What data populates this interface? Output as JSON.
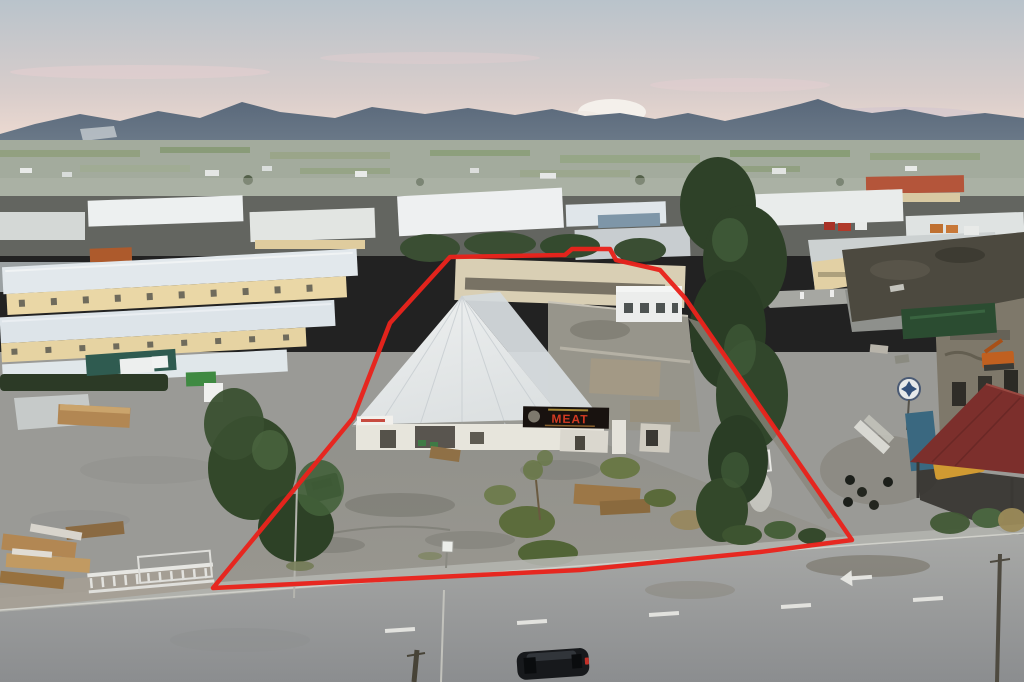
{
  "image": {
    "description": "Aerial dusk photograph of an industrial estate; a property parcel is outlined with a thick red boundary line. Mountain range on the horizon, wide asphalt road in the foreground with one dark car."
  },
  "boundary": {
    "color": "#e8231c",
    "stroke_width": 4.5,
    "points": "213,588 353,418 390,323 450,257 565,255 572,249 610,249 616,260 660,270 685,298 852,540 760,552 580,570"
  },
  "signs": {
    "meat": {
      "text": "MEAT",
      "bg": "#18120f",
      "color": "#d03a22",
      "accent": "#c9a43c"
    },
    "small_storefront": {
      "accent": "#c2392e"
    }
  },
  "palette": {
    "sky_top": "#b9c3cb",
    "sky_mid": "#d8cdcb",
    "sky_horizon": "#ecd9d0",
    "cloud_pink": "#e8cfd2",
    "cloud_white": "#f4f1ec",
    "mountain": "#59687a",
    "mountain_far": "#8b98a6",
    "plain": "#a3ab9d",
    "field_green": "#859a6e",
    "ground": "#9a9a96",
    "yard": "#91918b",
    "road_top": "#a8a9a7",
    "road_bottom": "#8b8d8f",
    "sidewalk": "#b3b4ae",
    "pavement_tan": "#a59f93",
    "warehouse_roof": "#e2e8ec",
    "warehouse_wall": "#ead7a6",
    "gable_roof": "#eef0f0",
    "flat_roof": "#97958b",
    "back_building": "#d9cfb4",
    "derelict_roof": "#4c493f",
    "derelict_wall": "#7e786a",
    "canopy_red": "#7c2f2c",
    "tarp_green": "#2b4c31",
    "container_teal": "#2f5b50",
    "container_blue": "#3a6880",
    "dumpster_green": "#3f8a42",
    "tree_dark": "#2e4128",
    "tree_light": "#44613c",
    "bush_olive": "#5c6c3c",
    "lumber": "#b28753",
    "fence_white": "#e6e6e2",
    "lane_marking": "#e8e8e4",
    "rust_shed": "#ad5a2c",
    "red_roof_distant": "#b4553a",
    "excavator_orange": "#c06020",
    "vehicle_yellow": "#d09a32",
    "car_black": "#17191c",
    "taillight_red": "#c23028",
    "yard_suv_green": "#222e1e"
  },
  "road": {
    "arrow_direction": "left"
  }
}
